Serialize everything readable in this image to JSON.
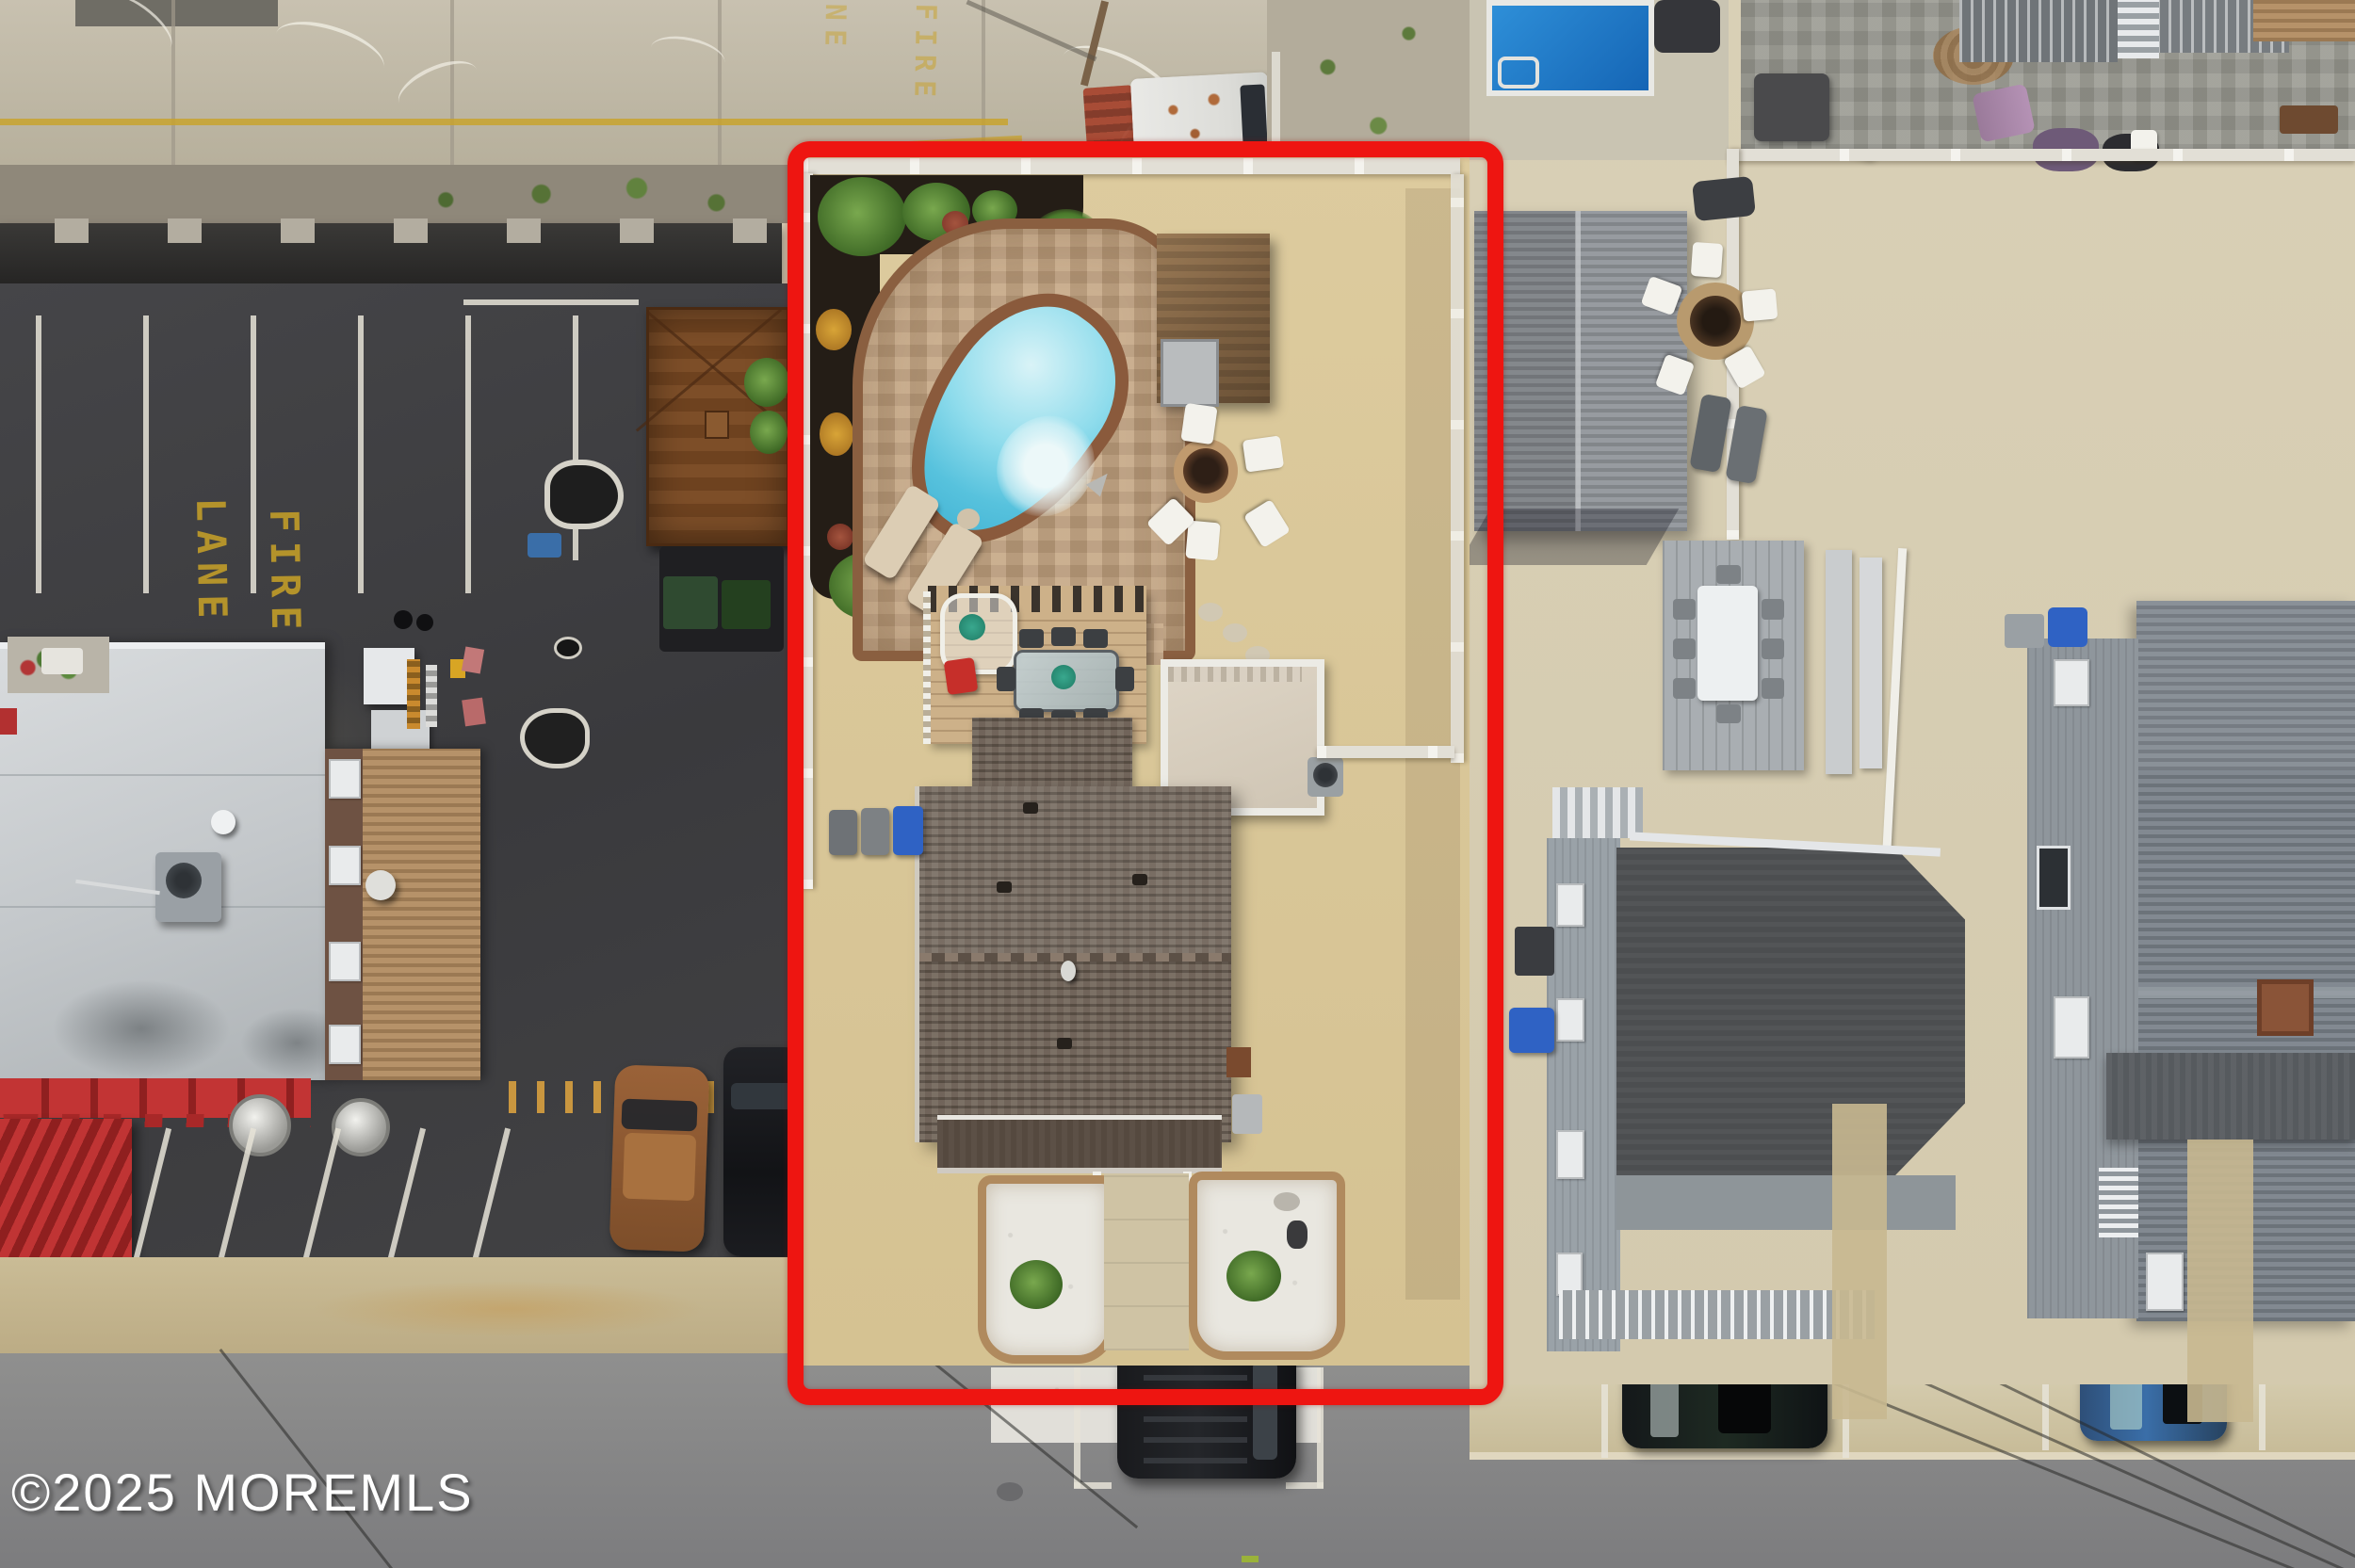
{
  "meta": {
    "type": "aerial-drone-photo",
    "subject": "shore property with freeform pool, paver patio, shed, deck and brown-roof house outlined in red; commercial parking lot to the left, neighboring sand-lot houses to the right, street along the bottom"
  },
  "watermark": {
    "text": "©2025 MOREMLS",
    "color": "#ffffff"
  },
  "markings": {
    "fire_word": "FIRE",
    "lane_word": "LANE",
    "paint_color": "#c9a227"
  },
  "highlight": {
    "color": "#ee1511",
    "shape": "rounded-rectangle",
    "meaning": "property-boundary-outline"
  },
  "colors": {
    "subject_sand": "#d9c89b",
    "neighbor_sand": "#d8cfb4",
    "pool_water": "#5ec6de",
    "neighbor_pool": "#1f78c8",
    "parking_asphalt": "#3e3e41",
    "street_asphalt": "#8b8b8d",
    "red_awning": "#bb2d2d",
    "house_roof": "#6d6054",
    "patio_paver": "#c2a27e"
  }
}
